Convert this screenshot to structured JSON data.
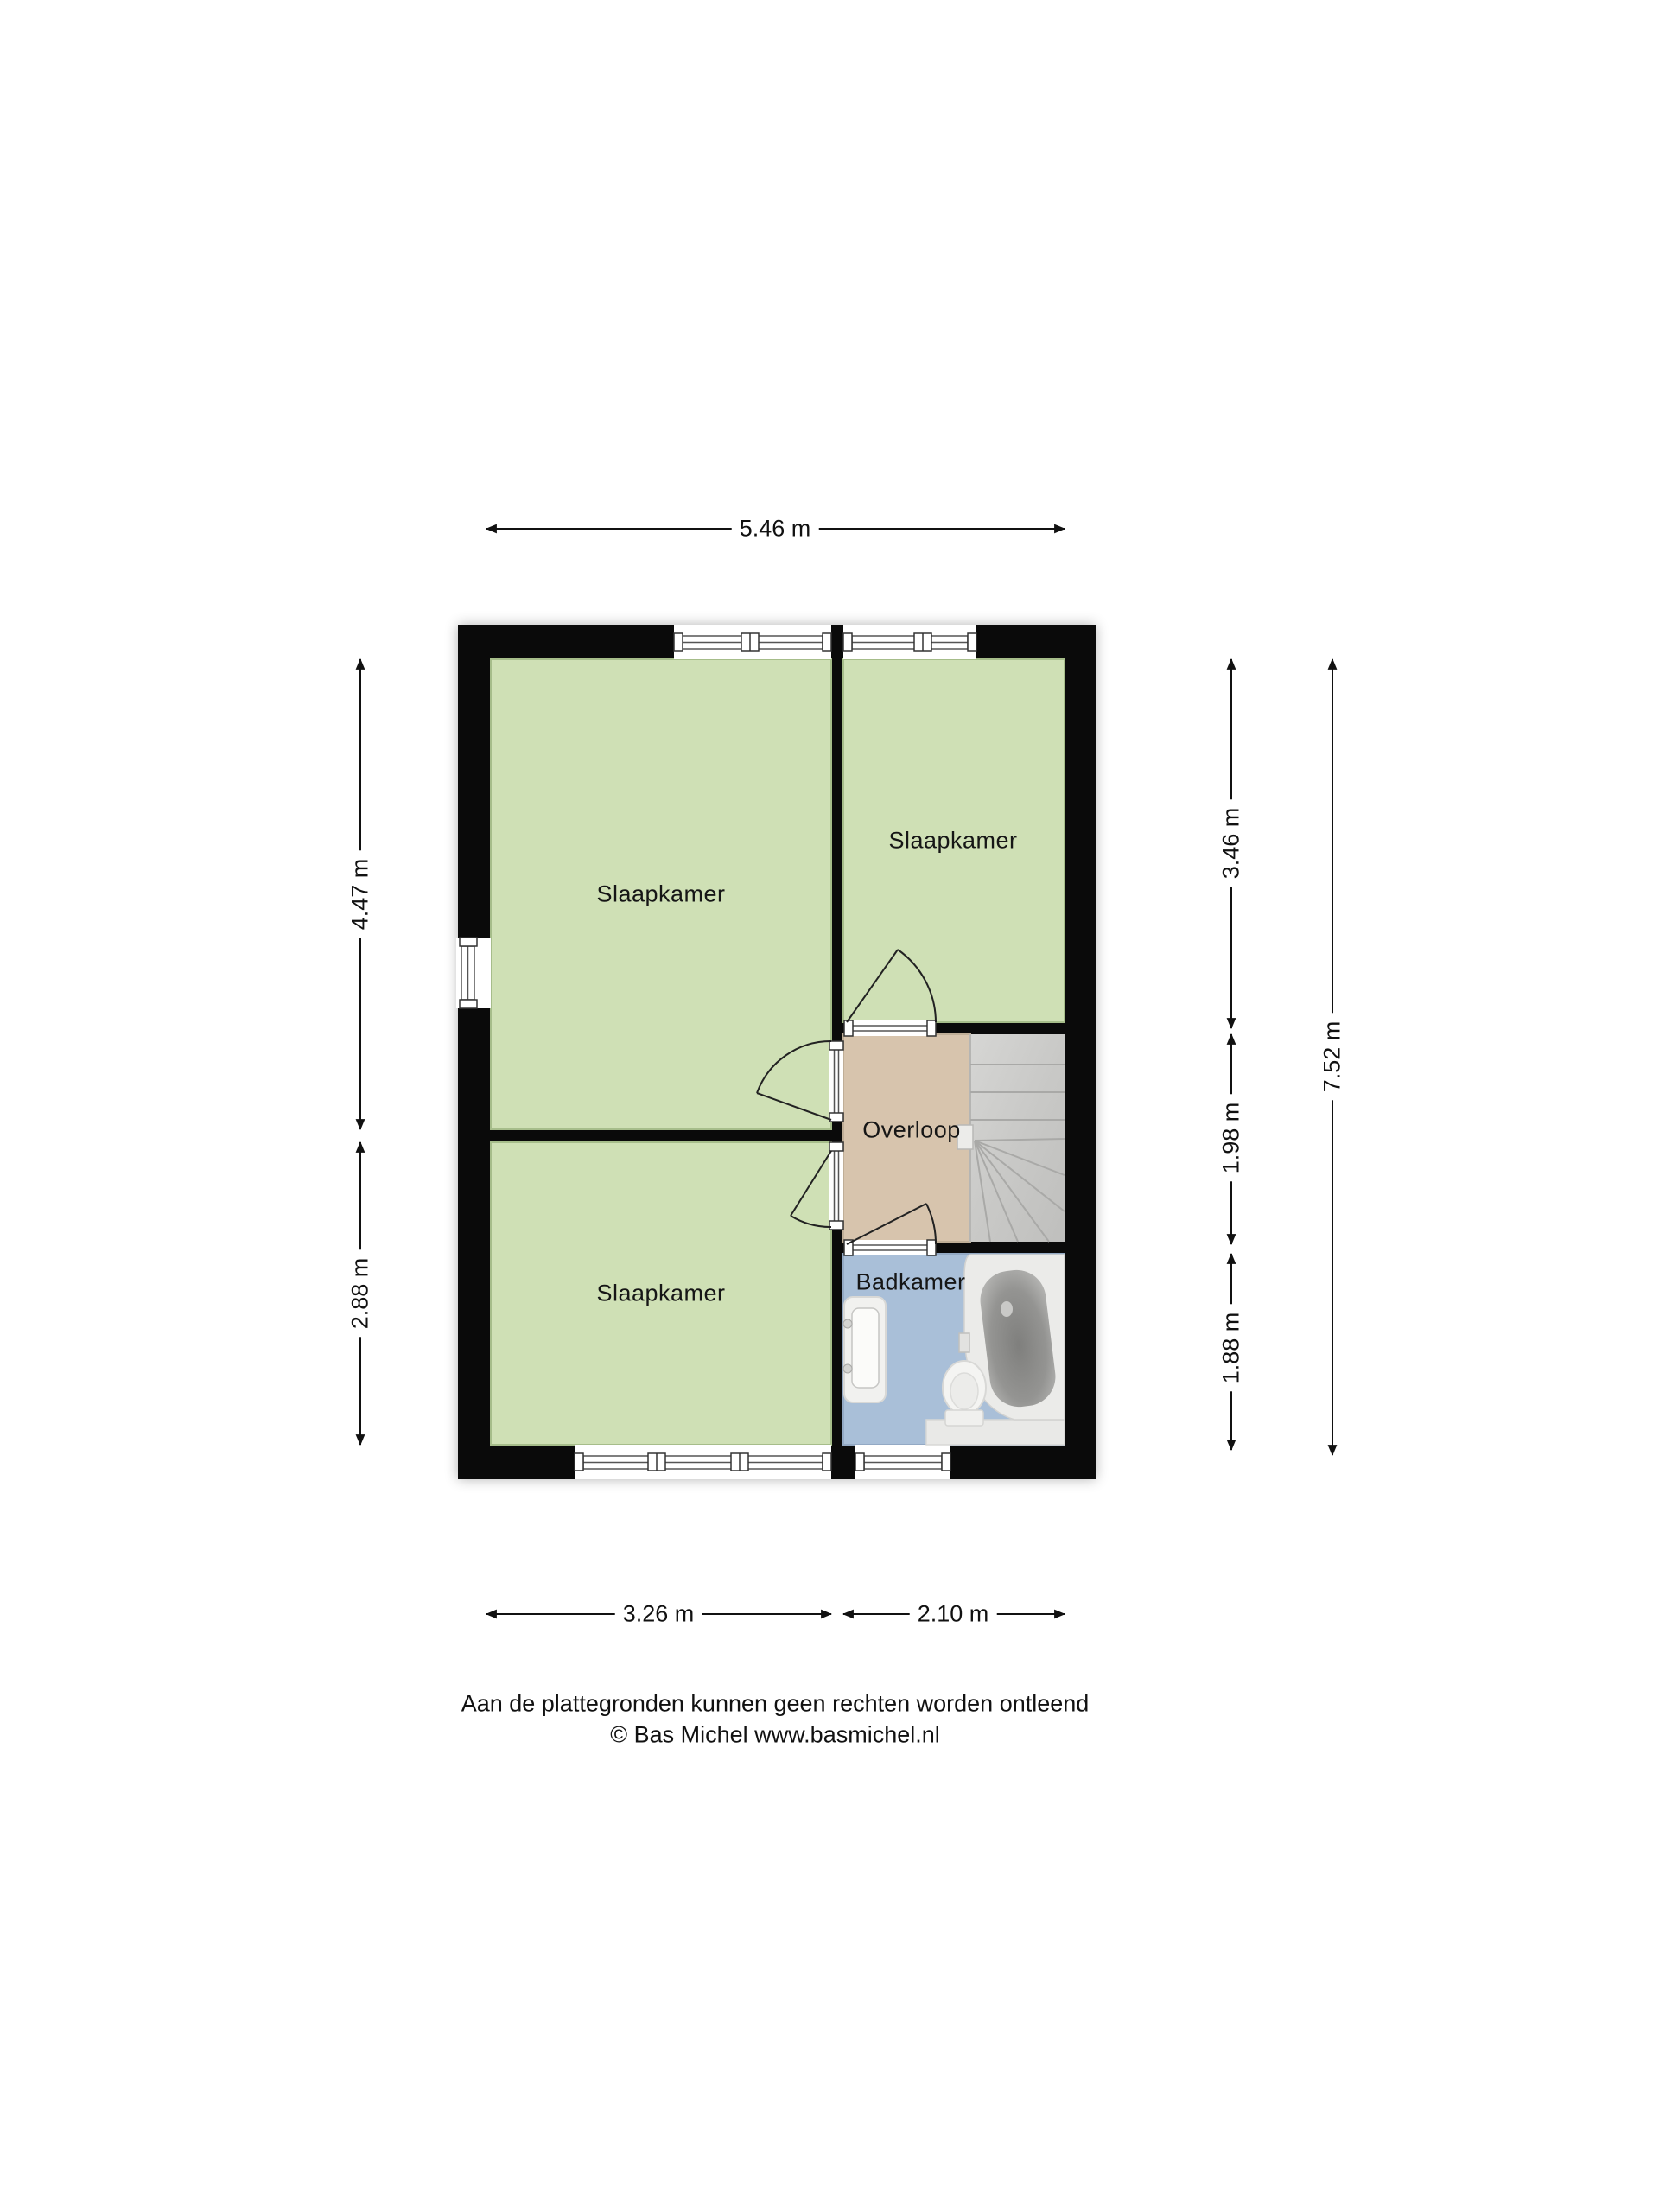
{
  "floorplan": {
    "title_none": "",
    "rooms": [
      {
        "id": "bedroom-large",
        "label": "Slaapkamer"
      },
      {
        "id": "bedroom-top-right",
        "label": "Slaapkamer"
      },
      {
        "id": "bedroom-bottom-left",
        "label": "Slaapkamer"
      },
      {
        "id": "landing",
        "label": "Overloop"
      },
      {
        "id": "bathroom",
        "label": "Badkamer"
      }
    ],
    "dimensions": {
      "top_width": "5.46 m",
      "left_upper": "4.47 m",
      "left_lower": "2.88 m",
      "right_top": "3.46 m",
      "right_middle": "1.98 m",
      "right_bottom": "1.88 m",
      "right_total": "7.52 m",
      "bottom_left": "3.26 m",
      "bottom_right": "2.10 m"
    },
    "footer": {
      "disclaimer": "Aan de plattegronden kunnen geen rechten worden ontleend",
      "credit": "© Bas Michel www.basmichel.nl"
    },
    "colors": {
      "wall": "#0a0a0a",
      "room_green": "#cfe0b5",
      "room_green_border": "#a6bd8a",
      "landing_tan": "#d7c4ad",
      "landing_tan_border": "#bfae97",
      "bathroom_blue": "#a9bfd8",
      "bathroom_blue_border": "#93a9c4",
      "stairs_gray": "#c9c9c9",
      "fixture_light": "#ebebe9",
      "tub_inner_dark": "#7f7f7d",
      "dimension_line": "#111111"
    }
  }
}
